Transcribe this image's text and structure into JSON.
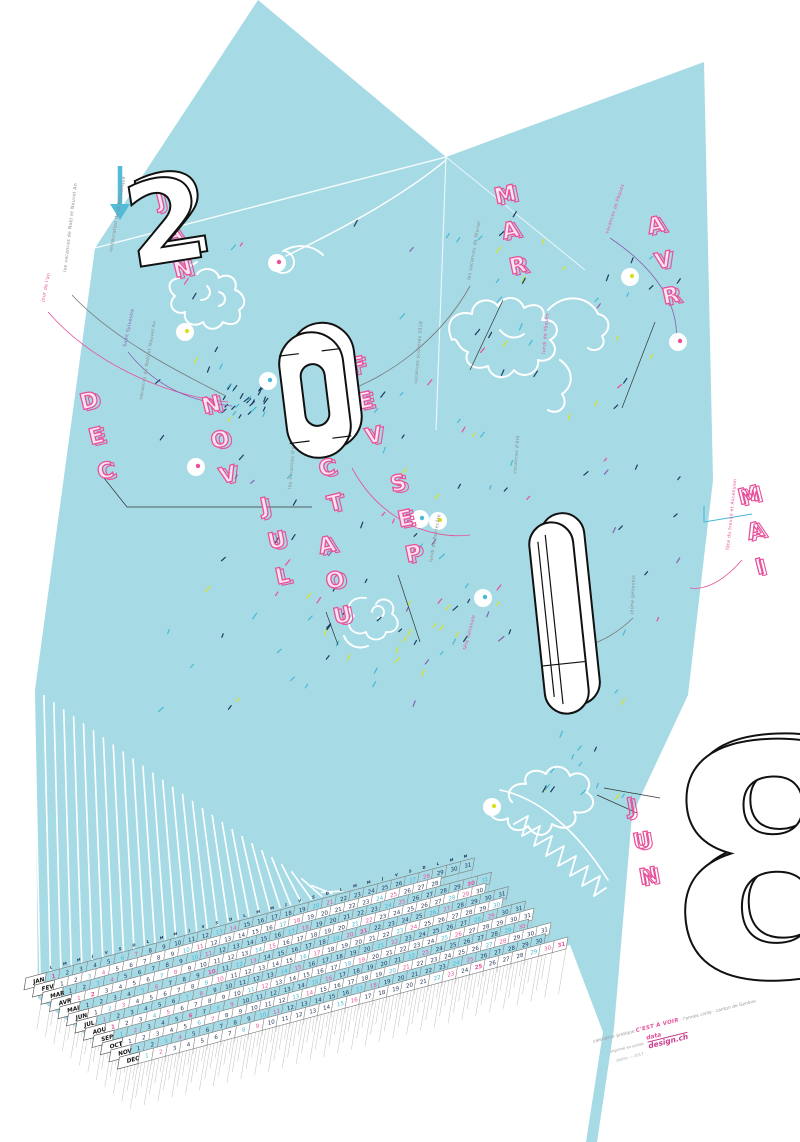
{
  "poster": {
    "year": "2018",
    "year_digits": [
      "2",
      "0",
      "1",
      "8"
    ],
    "weekday_letters": [
      "L",
      "M",
      "M",
      "J",
      "V",
      "S",
      "D"
    ],
    "months": [
      {
        "abbr": "JAN",
        "days": 31
      },
      {
        "abbr": "FEV",
        "days": 28
      },
      {
        "abbr": "MAR",
        "days": 31
      },
      {
        "abbr": "AVR",
        "days": 30
      },
      {
        "abbr": "MAI",
        "days": 31
      },
      {
        "abbr": "JUN",
        "days": 30
      },
      {
        "abbr": "JUL",
        "days": 31
      },
      {
        "abbr": "AOU",
        "days": 31
      },
      {
        "abbr": "SEP",
        "days": 30
      },
      {
        "abbr": "OCT",
        "days": 31
      },
      {
        "abbr": "NOV",
        "days": 30
      },
      {
        "abbr": "DEC",
        "days": 31
      }
    ],
    "holidays": {
      "JAN": [
        1
      ],
      "MAR": [
        30
      ],
      "AVR": [
        2
      ],
      "MAI": [
        10,
        21
      ],
      "AOU": [
        1
      ],
      "SEP": [
        6
      ],
      "DEC": [
        25,
        31
      ]
    },
    "annotations": [
      {
        "text": "les vacances de Noël et Nouvel An",
        "color": "gray"
      },
      {
        "text": "restauration de la République",
        "color": "gray"
      },
      {
        "text": "jour de l'an",
        "color": "pink"
      },
      {
        "text": "vacances de Noël et Nouvel An",
        "color": "gray"
      },
      {
        "text": "Saint Sylvestre",
        "color": "purple"
      },
      {
        "text": "les vacances de février",
        "color": "gray"
      },
      {
        "text": "vacances de Pâques",
        "color": "pink"
      },
      {
        "text": "lundi de Pâques",
        "color": "pink"
      },
      {
        "text": "vacances scolaires 2018",
        "color": "gray"
      },
      {
        "text": "les vacances d'automne",
        "color": "gray"
      },
      {
        "text": "vacances d'été",
        "color": "gray"
      },
      {
        "text": "jeûne genevois",
        "color": "gray"
      },
      {
        "text": "fête du travail et Ascension",
        "color": "pink"
      },
      {
        "text": "fête nationale",
        "color": "pink"
      },
      {
        "text": "lundi de Pentecôte",
        "color": "gray"
      }
    ],
    "credits": {
      "line1_prefix": "calendrier pratique",
      "brand": "C'EST À VOIR",
      "line1_suffix": "· l'année civile · canton de Genève",
      "printed": "imprimé en suisse",
      "logo_top": "data",
      "logo_bottom": "design.ch",
      "sub": "atelier — 2017"
    },
    "colors": {
      "sheet": "#a6dbe6",
      "pink": "#e8509a",
      "navy": "#1f3a5f",
      "cyan": "#49b8d6",
      "yellow": "#d9e021",
      "purple": "#8a5fae",
      "gray": "#8a8a8a"
    }
  }
}
